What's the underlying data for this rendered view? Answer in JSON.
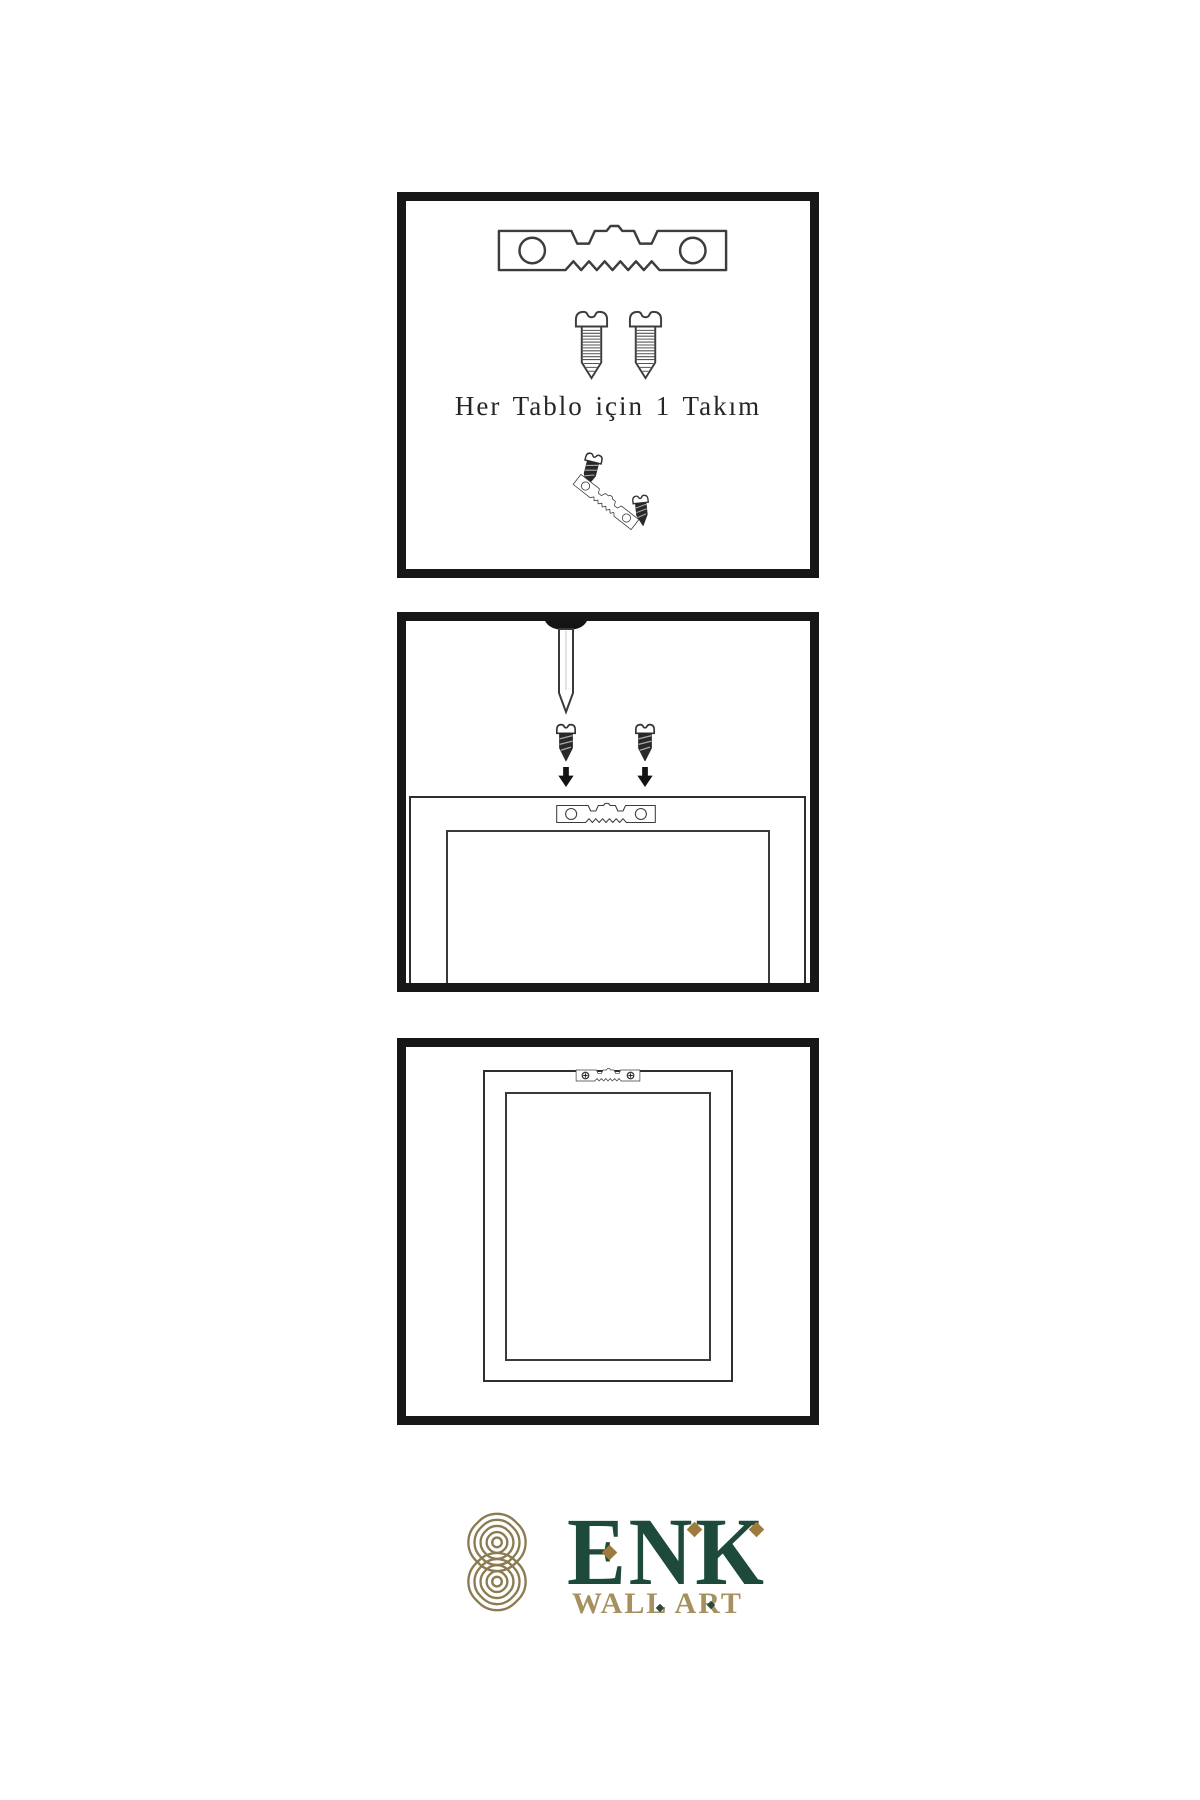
{
  "page": {
    "background": "#ffffff",
    "line_art_color": "#3d3d3d",
    "panel_border_color": "#171717"
  },
  "panel1": {
    "caption": "Her Tablo için 1 Takım",
    "contents": [
      "sawtooth-hanger-icon",
      "screw-icon",
      "screw-icon",
      "assembly-detail-cluster"
    ]
  },
  "panel2": {
    "contents": [
      "nail-icon",
      "screw-dark-icon",
      "screw-dark-icon",
      "down-arrow-icon",
      "down-arrow-icon",
      "frame-back-with-sawtooth-hanger"
    ]
  },
  "panel3": {
    "contents": [
      "hung-frame-with-screwed-sawtooth-hanger"
    ]
  },
  "brand": {
    "name": "ENK",
    "subtitle": "WALL ART",
    "colors": {
      "knot": "#8b7b50",
      "name": "#1d4a3a",
      "subtitle": "#a5905e",
      "diamond_accent": "#9c7b3c"
    },
    "logo_icon": "interlocking-knot-icon"
  }
}
